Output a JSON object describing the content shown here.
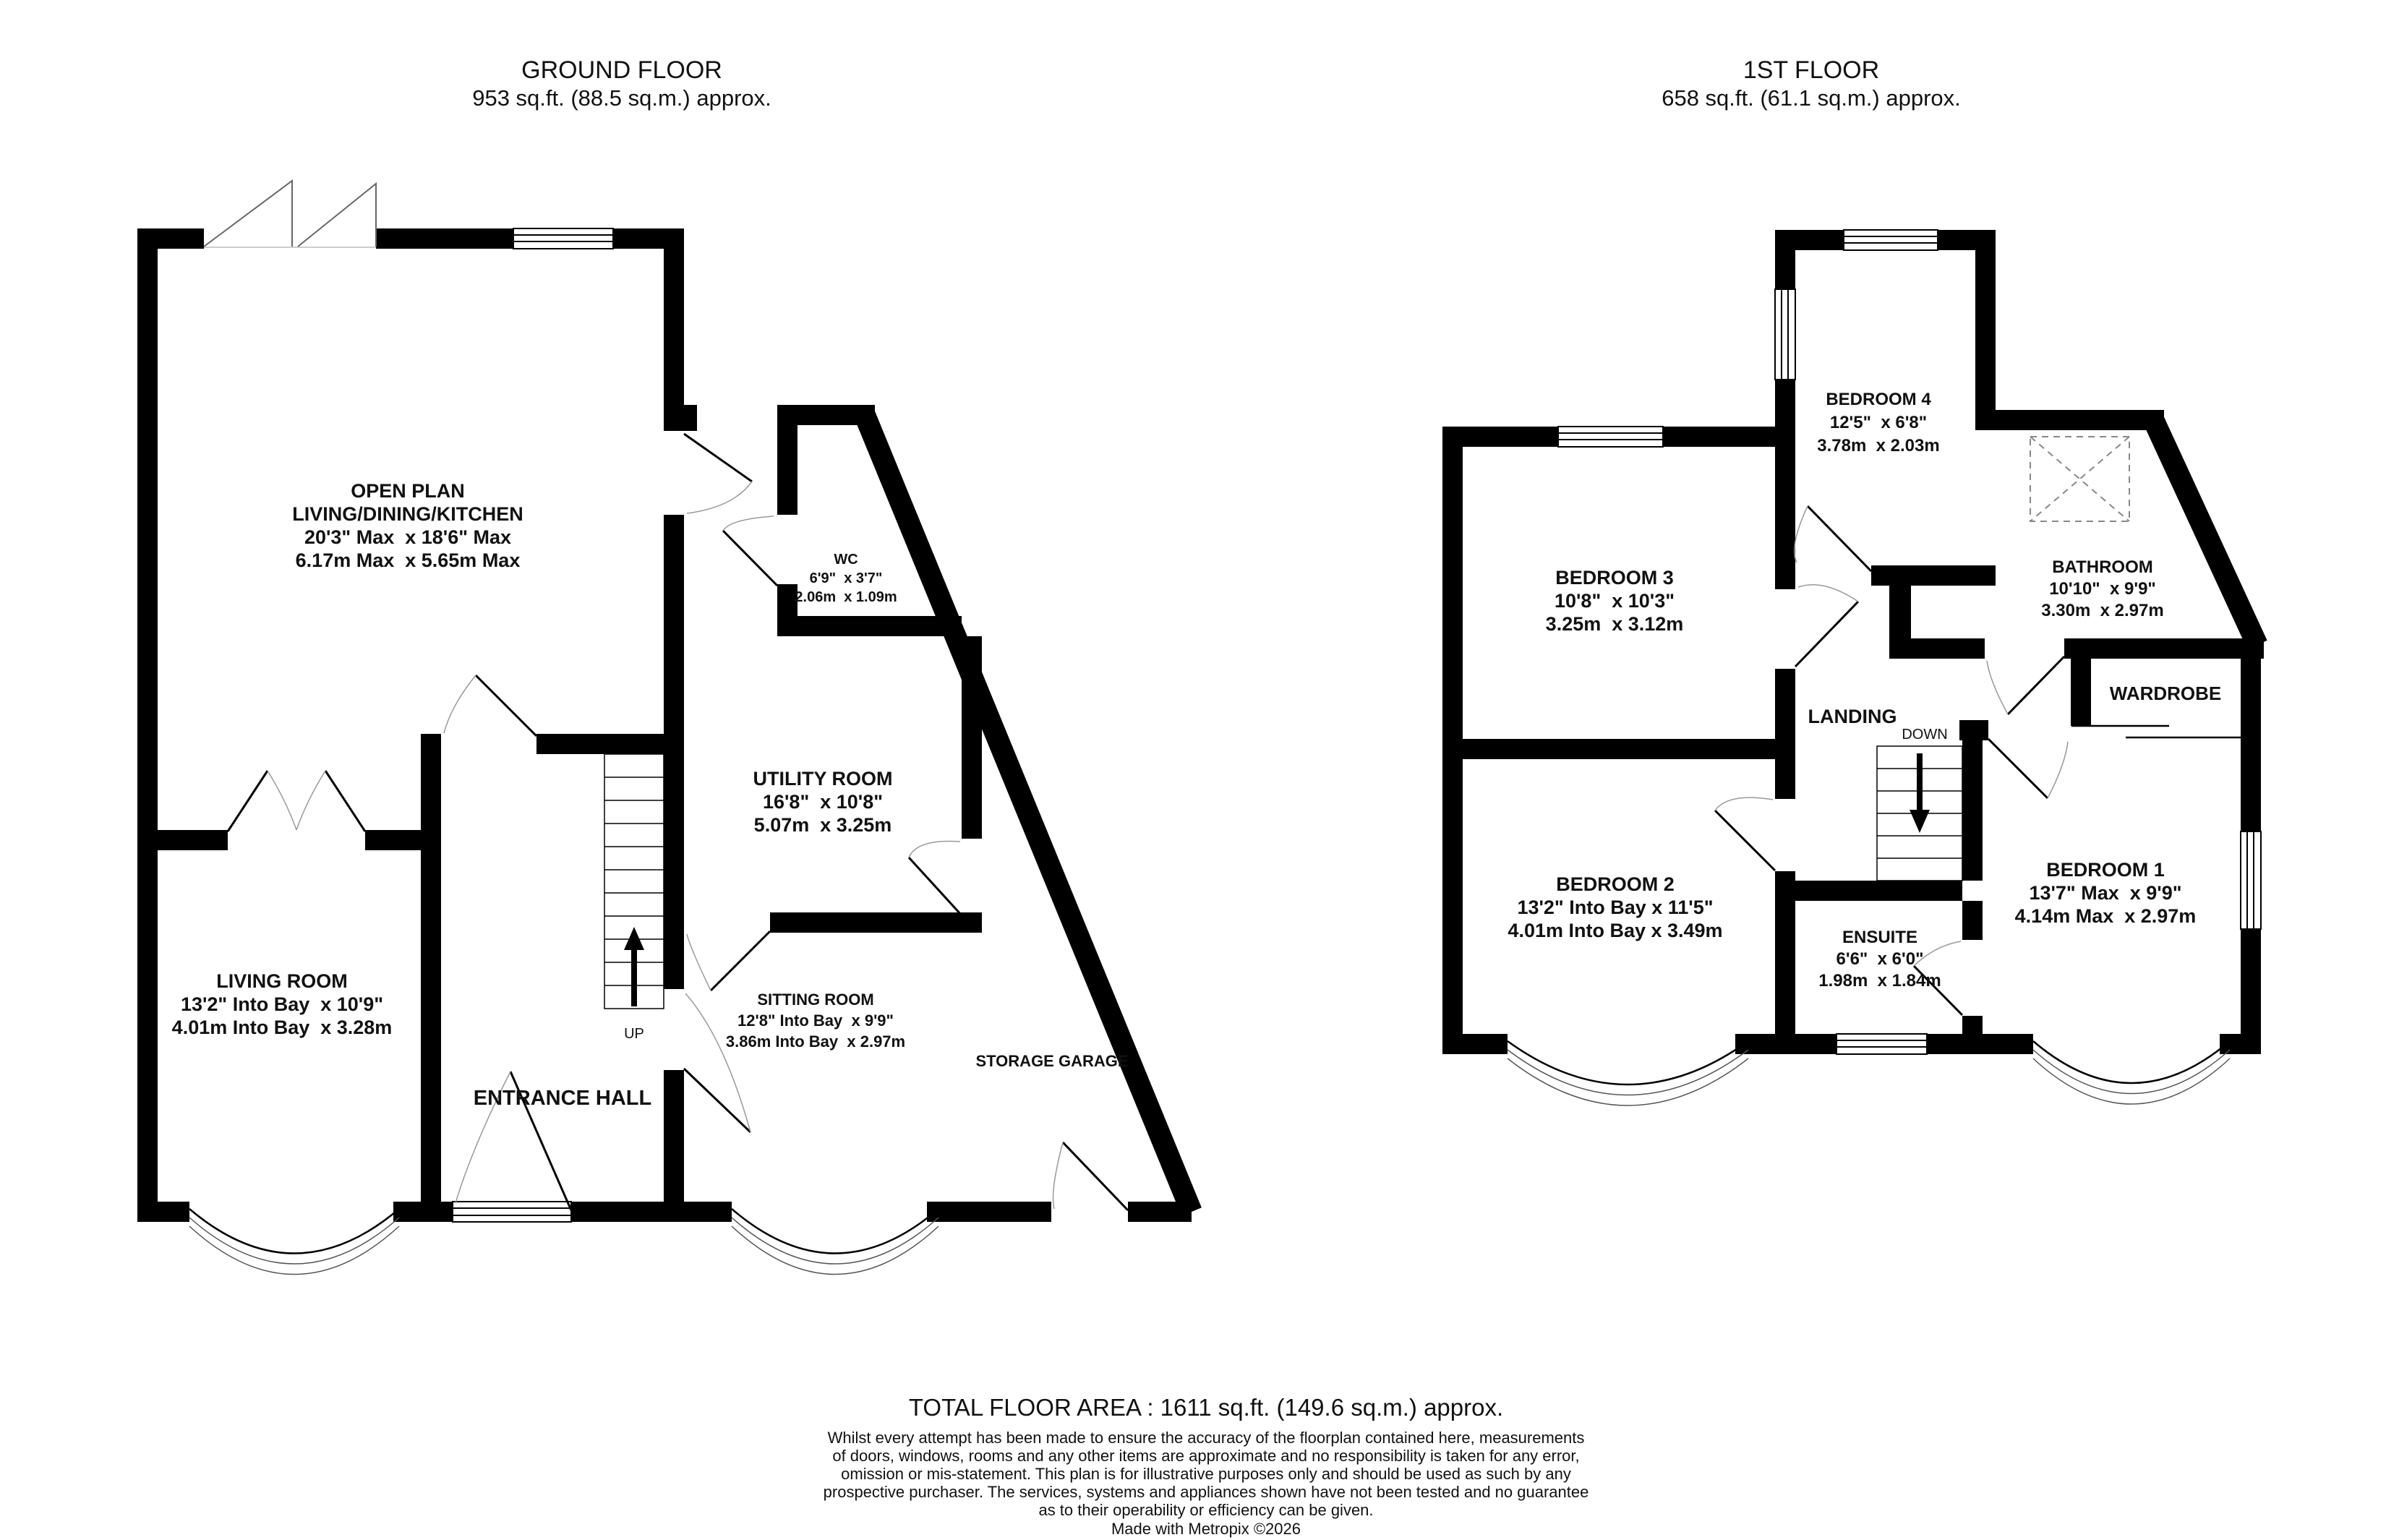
{
  "ground_floor": {
    "title": "GROUND FLOOR",
    "area": "953 sq.ft. (88.5 sq.m.) approx.",
    "stairs_label": "UP",
    "rooms": {
      "open_plan": {
        "line1": "OPEN PLAN",
        "line2": "LIVING/DINING/KITCHEN",
        "dims_imperial": "20'3\" Max  x 18'6\" Max",
        "dims_metric": "6.17m Max  x 5.65m Max"
      },
      "wc": {
        "line1": "WC",
        "dims_imperial": "6'9\"  x 3'7\"",
        "dims_metric": "2.06m  x 1.09m"
      },
      "utility_room": {
        "line1": "UTILITY ROOM",
        "dims_imperial": "16'8\"  x 10'8\"",
        "dims_metric": "5.07m  x 3.25m"
      },
      "living_room": {
        "line1": "LIVING ROOM",
        "dims_imperial": "13'2\" Into Bay  x 10'9\"",
        "dims_metric": "4.01m Into Bay  x 3.28m"
      },
      "entrance_hall": {
        "line1": "ENTRANCE HALL"
      },
      "sitting_room": {
        "line1": "SITTING ROOM",
        "dims_imperial": "12'8\" Into Bay  x 9'9\"",
        "dims_metric": "3.86m Into Bay  x 2.97m"
      },
      "storage_garage": {
        "line1": "STORAGE GARAGE"
      }
    }
  },
  "first_floor": {
    "title": "1ST FLOOR",
    "area": "658 sq.ft. (61.1 sq.m.) approx.",
    "stairs_label": "DOWN",
    "rooms": {
      "bedroom_4": {
        "line1": "BEDROOM 4",
        "dims_imperial": "12'5\"  x 6'8\"",
        "dims_metric": "3.78m  x 2.03m"
      },
      "bedroom_3": {
        "line1": "BEDROOM 3",
        "dims_imperial": "10'8\"  x 10'3\"",
        "dims_metric": "3.25m  x 3.12m"
      },
      "bathroom": {
        "line1": "BATHROOM",
        "dims_imperial": "10'10\"  x 9'9\"",
        "dims_metric": "3.30m  x 2.97m"
      },
      "landing": {
        "line1": "LANDING"
      },
      "wardrobe": {
        "line1": "WARDROBE"
      },
      "bedroom_2": {
        "line1": "BEDROOM 2",
        "dims_imperial": "13'2\" Into Bay x 11'5\"",
        "dims_metric": "4.01m Into Bay x 3.49m"
      },
      "ensuite": {
        "line1": "ENSUITE",
        "dims_imperial": "6'6\"  x 6'0\"",
        "dims_metric": "1.98m  x 1.84m"
      },
      "bedroom_1": {
        "line1": "BEDROOM 1",
        "dims_imperial": "13'7\" Max  x 9'9\"",
        "dims_metric": "4.14m Max  x 2.97m"
      }
    }
  },
  "footer": {
    "total_area": "TOTAL FLOOR AREA : 1611 sq.ft. (149.6 sq.m.) approx.",
    "disclaimer": [
      "Whilst every attempt has been made to ensure the accuracy of the floorplan contained here, measurements",
      "of doors, windows, rooms and any other items are approximate and no responsibility is taken for any error,",
      "omission or mis-statement. This plan is for illustrative purposes only and should be used as such by any",
      "prospective purchaser. The services, systems and appliances shown have not been tested and no guarantee",
      "as to their operability or efficiency can be given."
    ],
    "credit": "Made with Metropix ©2026"
  },
  "colors": {
    "wall": "#000000",
    "background": "#ffffff",
    "door_arc": "#999999"
  }
}
